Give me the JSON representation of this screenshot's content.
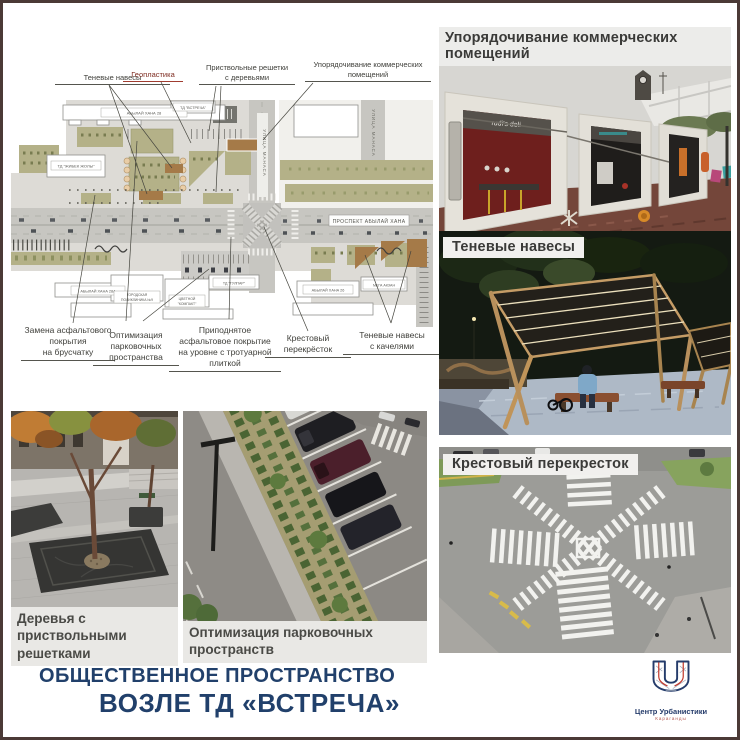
{
  "colors": {
    "accent_navy": "#21406b",
    "frame_brown": "#4b3a36",
    "callout_red": "#a03c30",
    "plan_green": "#b4b188"
  },
  "plan": {
    "callouts_top": {
      "shade": "Теневые навесы",
      "geo": "Геопластика",
      "grates_1": "Приствольные решетки",
      "grates_2": "с деревьями",
      "commercial_1": "Упорядочивание коммерческих",
      "commercial_2": "помещений"
    },
    "callouts_bottom": {
      "pavers_1": "Замена асфальтового",
      "pavers_2": "покрытия",
      "pavers_3": "на брусчатку",
      "parking_1": "Оптимизация",
      "parking_2": "парковочных",
      "parking_3": "пространства",
      "raised_1": "Приподнятое",
      "raised_2": "асфальтовое покрытие",
      "raised_3": "на уровне с тротуарной",
      "raised_4": "плиткой",
      "cross_1": "Крестовый",
      "cross_2": "перекрёсток",
      "swing_1": "Теневые навесы",
      "swing_2": "с качелями"
    },
    "streets": {
      "manasa": "УЛИЦА МАНАСА",
      "manasa2": "УЛИЦА МАНАСА",
      "abylai": "ПРОСПЕКТ АБЫЛАЙ ХАНА"
    },
    "buildings": {
      "b28": "АБЫЛАЙ ХАНА 28",
      "vstrecha": "ТД \"ВСТРЕЧА\"",
      "zhibek": "ТД \"ЖИБЕК ЖОЛЫ\"",
      "b28a": "АБЫЛАЙ ХАНА 28А",
      "clinic_1": "ГОРОДСКАЯ",
      "clinic_2": "ПОЛИКЛИНИКА №9",
      "tsvetnoy_1": "ЦВЕТНОЙ",
      "tsvetnoy_2": "\"КОМПАКТ\"",
      "tulpar": "ТД \"ТУЛПАР\"",
      "b26": "АБЫЛАЙ ХАНА 26",
      "mega": "МЕГА АКЗАН"
    }
  },
  "photos": {
    "kiosks": {
      "title": "Упорядочивание коммерческих помещений",
      "sign": "rudi's deli"
    },
    "canopy": {
      "title": "Теневые навесы"
    },
    "intersection": {
      "title": "Крестовый перекресток"
    },
    "trees": {
      "caption_1": "Деревья с приствольными",
      "caption_2": "решетками"
    },
    "parking": {
      "caption": "Оптимизация парковочных пространств"
    }
  },
  "footer": {
    "title_line1": "ОБЩЕСТВЕННОЕ ПРОСТРАНСТВО",
    "title_line2": "ВОЗЛЕ ТД «ВСТРЕЧА»",
    "logo_name": "Центр Урбанистики",
    "logo_sub": "Караганды"
  }
}
